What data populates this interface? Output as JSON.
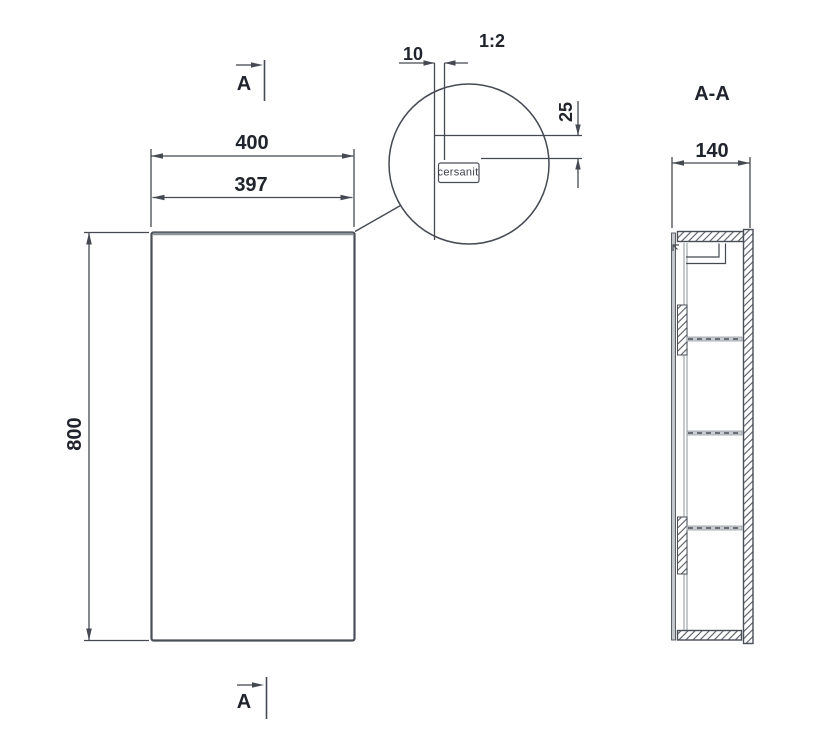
{
  "drawing": {
    "front_view": {
      "width": "400",
      "door_width": "397",
      "height": "800"
    },
    "section_view": {
      "title": "A-A",
      "depth": "140"
    },
    "detail_view": {
      "scale": "1:2",
      "door_thickness": "10",
      "logo_offset": "25",
      "logo": "cersanit"
    },
    "section_marks": {
      "top": "A",
      "bottom": "A"
    },
    "colors": {
      "line": "#454a52",
      "text": "#20242c",
      "gray": "#9aa0a6",
      "background": "#ffffff"
    }
  }
}
